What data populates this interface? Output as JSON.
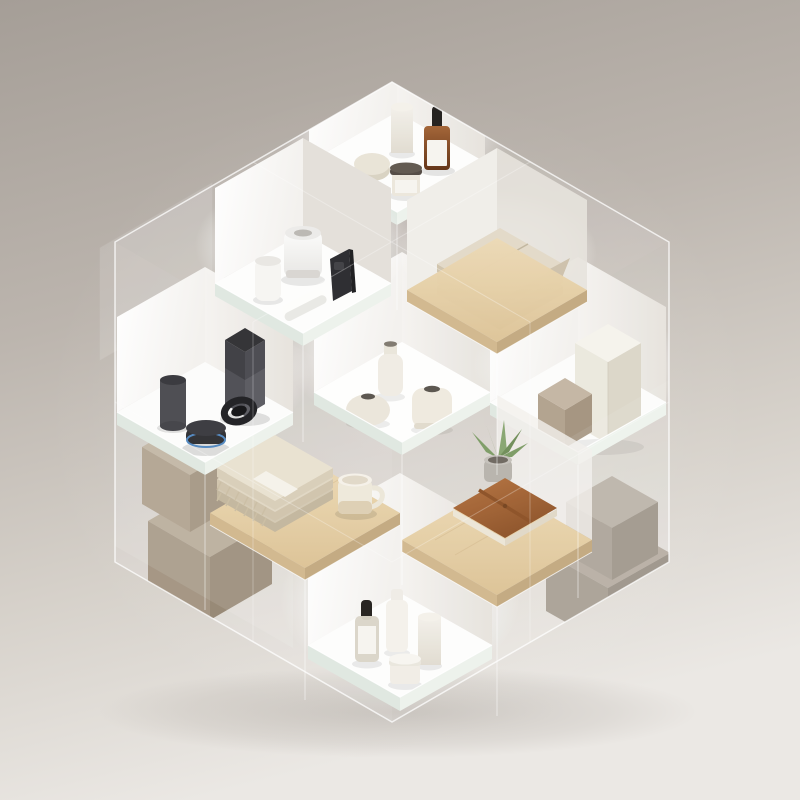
{
  "meta": {
    "title": "Isometric glass display cubes with lifestyle products",
    "description": "3D rendered hexagonal stack of glass display boxes with backlit white alcoves and wooden shelves holding skincare, smart speakers, ceramic vases, textiles, boxes and stationery on a warm grey backdrop."
  },
  "palette": {
    "bg-top": "#a79f99",
    "bg-bottom": "#eae7e3",
    "glass-edge": "#ffffff",
    "slab-left": "#dfe7e0",
    "slab-right": "#edf2ec",
    "alcove-white": "#fdfdfc",
    "wood-top": "#e4cda7",
    "wood-side": "#d0b68c",
    "cream": "#efe9df",
    "amber-glass": "#7c4018",
    "label-white": "#f6f4ef",
    "device-dark": "#3a3a3f",
    "echo-blue": "#4f86c0",
    "device-white": "#fafaf8",
    "taupe-box": "#b0a08c",
    "greige-box": "#a39a8e",
    "leather-brown": "#a4622f",
    "plant-green": "#7b9a63",
    "towel-beige": "#e0d7c3",
    "mug-cream": "#eee8da"
  },
  "scene": {
    "cells": [
      {
        "label": "Top shelf — skincare set",
        "items": [
          "cream cylinder bottle",
          "oval soap bar",
          "amber glass dropper bottle with white label",
          "cream jar with dark lid"
        ]
      },
      {
        "label": "Center backlit shelf — ceramic vases",
        "items": [
          "tall bottle vase",
          "round squat vase",
          "bell shaped vase"
        ]
      },
      {
        "label": "Right shelf — gift boxes",
        "items": [
          "large cream box",
          "small taupe box"
        ]
      },
      {
        "label": "Bottom backlit shelf — cosmetic bottles",
        "items": [
          "glass dropper bottle",
          "white pump bottle",
          "white cylinder bottle",
          "small cream jar"
        ]
      },
      {
        "label": "Lower left — stacked taupe boxes behind glass",
        "items": [
          "upper taupe box",
          "lower taupe box"
        ]
      },
      {
        "label": "Left shelf — dark audio gadgets",
        "items": [
          "tall dark smart speaker",
          "dark cylinder speaker",
          "round speaker with blue light ring",
          "black smartwatch"
        ]
      },
      {
        "label": "Upper left shelf — white smart devices",
        "items": [
          "large white smart speaker",
          "small white speaker",
          "black smartphone",
          "white wireless remote"
        ]
      },
      {
        "label": "Upper right wooden shelf — folded towel",
        "items": [
          "folded beige towel"
        ]
      },
      {
        "label": "Lower right — stacked greige boxes behind glass",
        "items": [
          "upper greige box",
          "lower greige box"
        ]
      },
      {
        "label": "Lower left wooden shelf — textiles",
        "items": [
          "fringed blanket stack with paper band",
          "cream ceramic mug"
        ]
      },
      {
        "label": "Lower right wooden shelf — stationery",
        "items": [
          "brown leather notebook",
          "succulent in concrete pot"
        ]
      }
    ]
  }
}
